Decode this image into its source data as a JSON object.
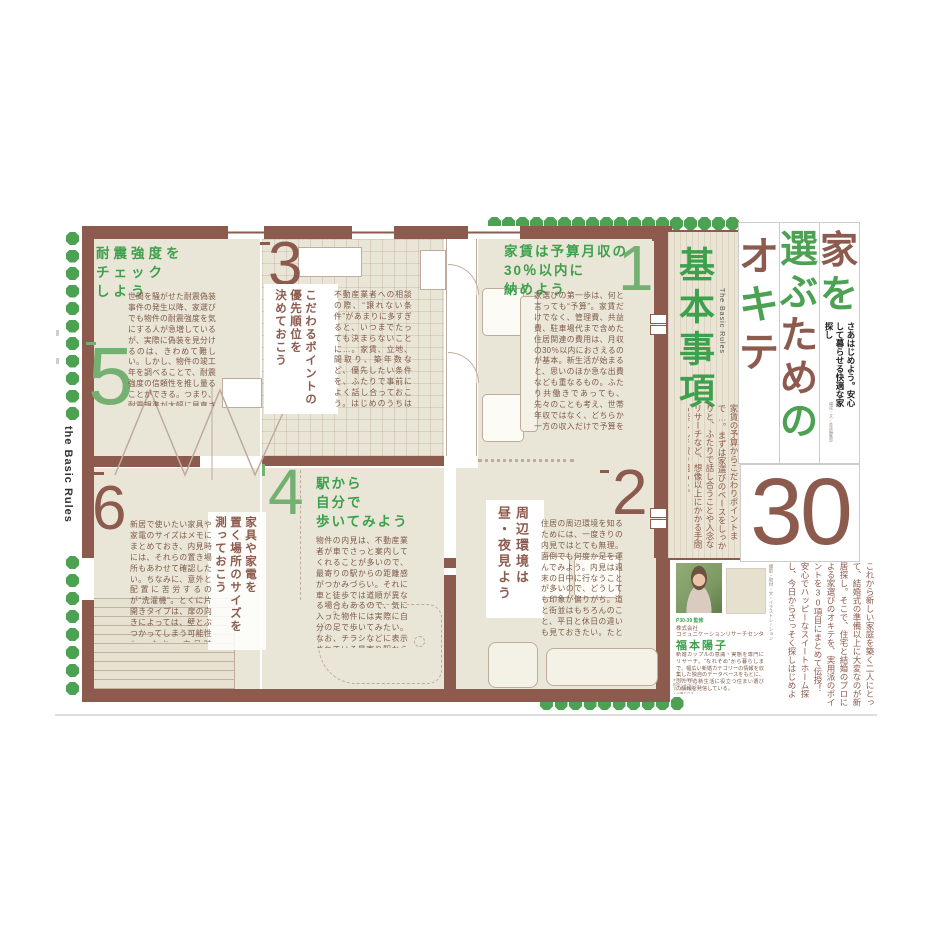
{
  "colors": {
    "accent_green": "#3da04c",
    "accent_brown": "#8d5b4e",
    "dot_green": "#4da152",
    "num_green": "#74b071",
    "beige": "#eae6d7",
    "wall": "#8d5b4e",
    "line": "#bfab9b",
    "body_text": "#7c5848"
  },
  "left_rail": {
    "label": "the Basic Rules"
  },
  "title": {
    "col1": [
      {
        "ch": "家",
        "color": "c-brown"
      },
      {
        "ch": "を",
        "color": "c-green"
      }
    ],
    "col2": [
      {
        "ch": "選",
        "color": "c-green"
      },
      {
        "ch": "ぶ",
        "color": "c-green"
      },
      {
        "ch": "た",
        "color": "c-brown"
      },
      {
        "ch": "め",
        "color": "c-brown"
      },
      {
        "ch": "の",
        "color": "c-green"
      }
    ],
    "col3": [
      {
        "ch": "オ",
        "color": "c-brown"
      },
      {
        "ch": "キ",
        "color": "c-green"
      },
      {
        "ch": "テ",
        "color": "c-brown"
      }
    ],
    "subtitle": "さあはじめよう。安心して暮らせる快適な家探し",
    "note": "構成・文／本誌編集部",
    "count": "30"
  },
  "lead": {
    "text": "これから新しい家庭を築く二人にとって、結婚式の準備以上に大変なのが新居探し。そこで、住宅と結婚のプロによる家選びのオキテを、実用派のポイントを30項目にまとめて伝授！　安心でハッピーなスイートホーム探し、今日からさっそく探しはじめよう！",
    "credits": "撮影・取材・文・イラストレーション"
  },
  "basics": {
    "title": "基本事項",
    "subtitle_en": "The Basic Rules",
    "intro": "家賃の予算からこだわりポイントまで…。まずは家選びのベースをしっかりと、ふたりで話し合うことや入念なリサーチなど、想像以上にかかる手間も楽しんで取り組もう。"
  },
  "rules": [
    {
      "num": "1",
      "headline": "家賃は予算月収の\n30％以内に\n納めよう",
      "body": "家選びの第一歩は、何と言っても“予算”。家賃だけでなく、管理費、共益費、駐車場代まで含めた住居関連の費用は、月収の30％以内におさえるのが基本。新生活が始まると、思いのほか急な出費なども重なるもの。ふたり共働きであっても、先々のことも考え、世帯年収ではなく、どちらか一方の収入だけで予算を組み、家計にゆとりをもたせたい。また、不動産業者は“予算の上限を超える物件”を紹介してくるもの。魅力的な誘いにも動じない、強い意志力も必要。"
    },
    {
      "num": "2",
      "headline": "周辺環境は\n昼・夜見よう",
      "body": "住居の周辺環境を知るためには、一度きりの内見ではとても無理。面倒でも何度か足を運んでみよう。内見は週末の日中に行なうことが多いので、どうしても印象が偏りがち。道と街並はもちろんのこと、平日と休日の違いも見ておきたい。たとえば近くに飲食店やカラオケがあると、平日夜は騒々しい場合が多いことが。また、近隣の工場から出される騒音や煙、匂いなどで、平日の昼間は窓も開けられない可能性も。街が持つさまざまな“顔”を見きわめた上で判断を。"
    },
    {
      "num": "3",
      "headline": "こだわるポイントの\n優先順位を\n決めておこう",
      "body": "不動産業者への相談の際、“譲れない条件”があまりに多すぎると、いつまでたっても決まらないことに…。家賃、立地、間取り、築年数など、優先したい条件を、ふたりで事前によく話し合っておこう。はじめのうちはお互いの意見がうまくまとまらなくても、物件を数多く見て回っていくうちに、共通する好みやこだわりポイントが自ずと見えてくるはず。家選びのベースが明確になると、現実的な折り合いがつけられるようになり、結果、早く決まることに。"
    },
    {
      "num": "4",
      "headline": "駅から\n自分で\n歩いてみよう",
      "body": "物件の内見は、不動産業者が車でさっと案内してくれることが多いので、最寄りの駅からの距離感がつかみづらい。それに車と徒歩では道順が異なる場合もあるので、気に入った物件には実際に自分の足で歩いてみたい。なお、チラシなどに表示されている最寄り駅からの徒歩所要時間は、1分＝80mで計算。これは女性にとって、少々急ぎ足ペースに相当。途中に上り坂などがあると、表示時間の1.5倍近くかかってしまう場合も。"
    },
    {
      "num": "5",
      "headline": "耐震強度を\nチェック\nしよう",
      "body": "世間を騒がせた耐震偽装事件の発生以降、家選びでも物件の耐震強度を気にする人が急増しているが、実際に偽装を見分けるのは、きわめて難しい。しかし、物件の竣工年を調べることで、耐震強度の信頼性を推し量ることができる。つまり、耐震規準が大幅に見直された“新耐震法”が成立した昭和56年以降の建築物であれば、基本的には大丈夫。加えて、平成7年の阪神大震災以降のものは、審査がさらに厳しくなっているため、より安心できそうだ。"
    },
    {
      "num": "6",
      "headline": "家具や家電を\n置く場所のサイズを\n測っておこう",
      "body": "新居で使いたい家具や家電のサイズはメモにまとめておき、内見時には、それらの置き場所もあわせて確認したい。ちなみに、意外と配置に苦労するのが“洗濯機”。とくに片開きタイプは、扉の向きによっては、壁とぶつかってしまう可能性も。なお、内見時の“三種の神器”と言われているメジャー、方位磁針、ビー玉のうち、部屋の傾きを調べるビー玉は不要。不動産業者を通じて「神経質すぎる」という印象がオーナーに伝わってしまい、入居審査でマイナス要因に。"
    }
  ],
  "profile": {
    "role": "P30-39 監修",
    "company": "株式会社",
    "org": "コミュニケーションリサーチセンター",
    "name": "福本陽子",
    "bio": "新婚カップルの意識・実態を専門にリサーチ。“なれそめ”から暮らしまで、幅広い新婚カテゴリーの情報を収集した独自のデータベースをもとに、ふたりの新生活に役立つ住まい選びの情報を発信している。"
  },
  "plan_note": "※掲載の間取り図はイメージです。実際の物件とは異なります。"
}
